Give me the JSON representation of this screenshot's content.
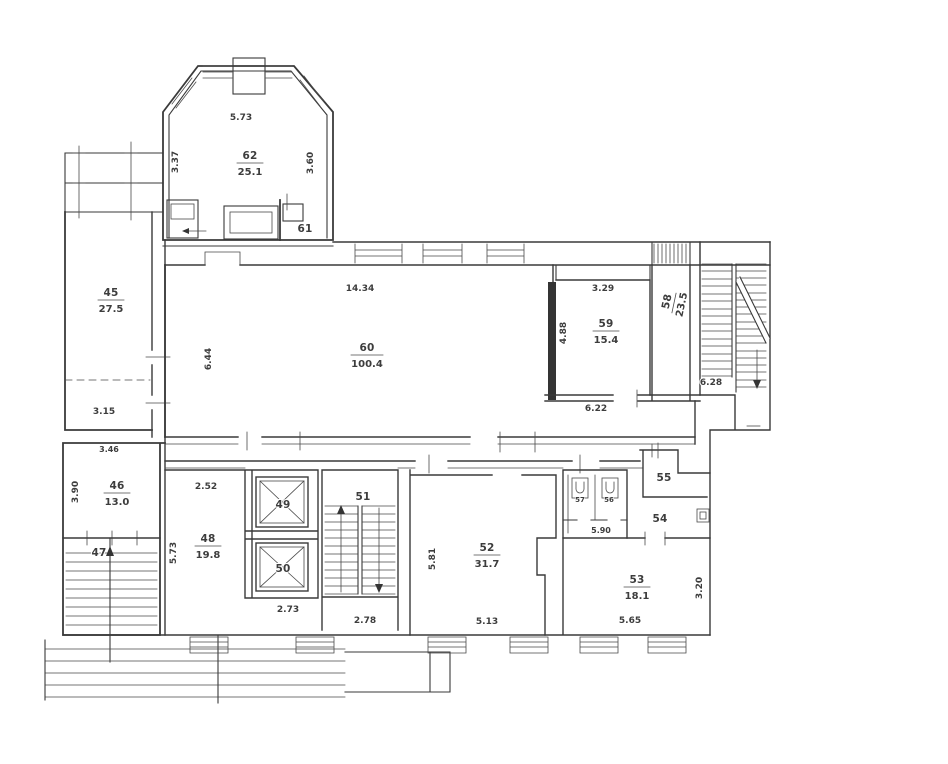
{
  "colors": {
    "ink": "#3a3a3a",
    "paper": "#ffffff"
  },
  "plan": {
    "rooms": {
      "r45": {
        "number": "45",
        "area": "27.5"
      },
      "r46": {
        "number": "46",
        "area": "13.0"
      },
      "r47": {
        "number": "47"
      },
      "r48": {
        "number": "48",
        "area": "19.8"
      },
      "r49": {
        "number": "49"
      },
      "r50": {
        "number": "50"
      },
      "r51": {
        "number": "51"
      },
      "r52": {
        "number": "52",
        "area": "31.7"
      },
      "r53": {
        "number": "53",
        "area": "18.1"
      },
      "r54": {
        "number": "54"
      },
      "r55": {
        "number": "55"
      },
      "r56": {
        "number": "56"
      },
      "r57": {
        "number": "57"
      },
      "r58": {
        "number": "58",
        "area": "23.5"
      },
      "r59": {
        "number": "59",
        "area": "15.4"
      },
      "r60": {
        "number": "60",
        "area": "100.4"
      },
      "r61": {
        "number": "61"
      },
      "r62": {
        "number": "62",
        "area": "25.1"
      }
    },
    "dims": {
      "w62": "5.73",
      "l62": "3.37",
      "r62": "3.60",
      "w60": "14.34",
      "l60": "6.44",
      "t59": "3.29",
      "l59": "4.88",
      "b59": "6.22",
      "stair_right": "6.28",
      "b45": "3.15",
      "t46": "3.46",
      "l46": "3.90",
      "t48": "2.52",
      "l48": "5.73",
      "b_elev": "2.73",
      "b51": "2.78",
      "l52": "5.81",
      "b52": "5.13",
      "t53": "5.90",
      "b53": "5.65",
      "r53": "3.20"
    }
  }
}
